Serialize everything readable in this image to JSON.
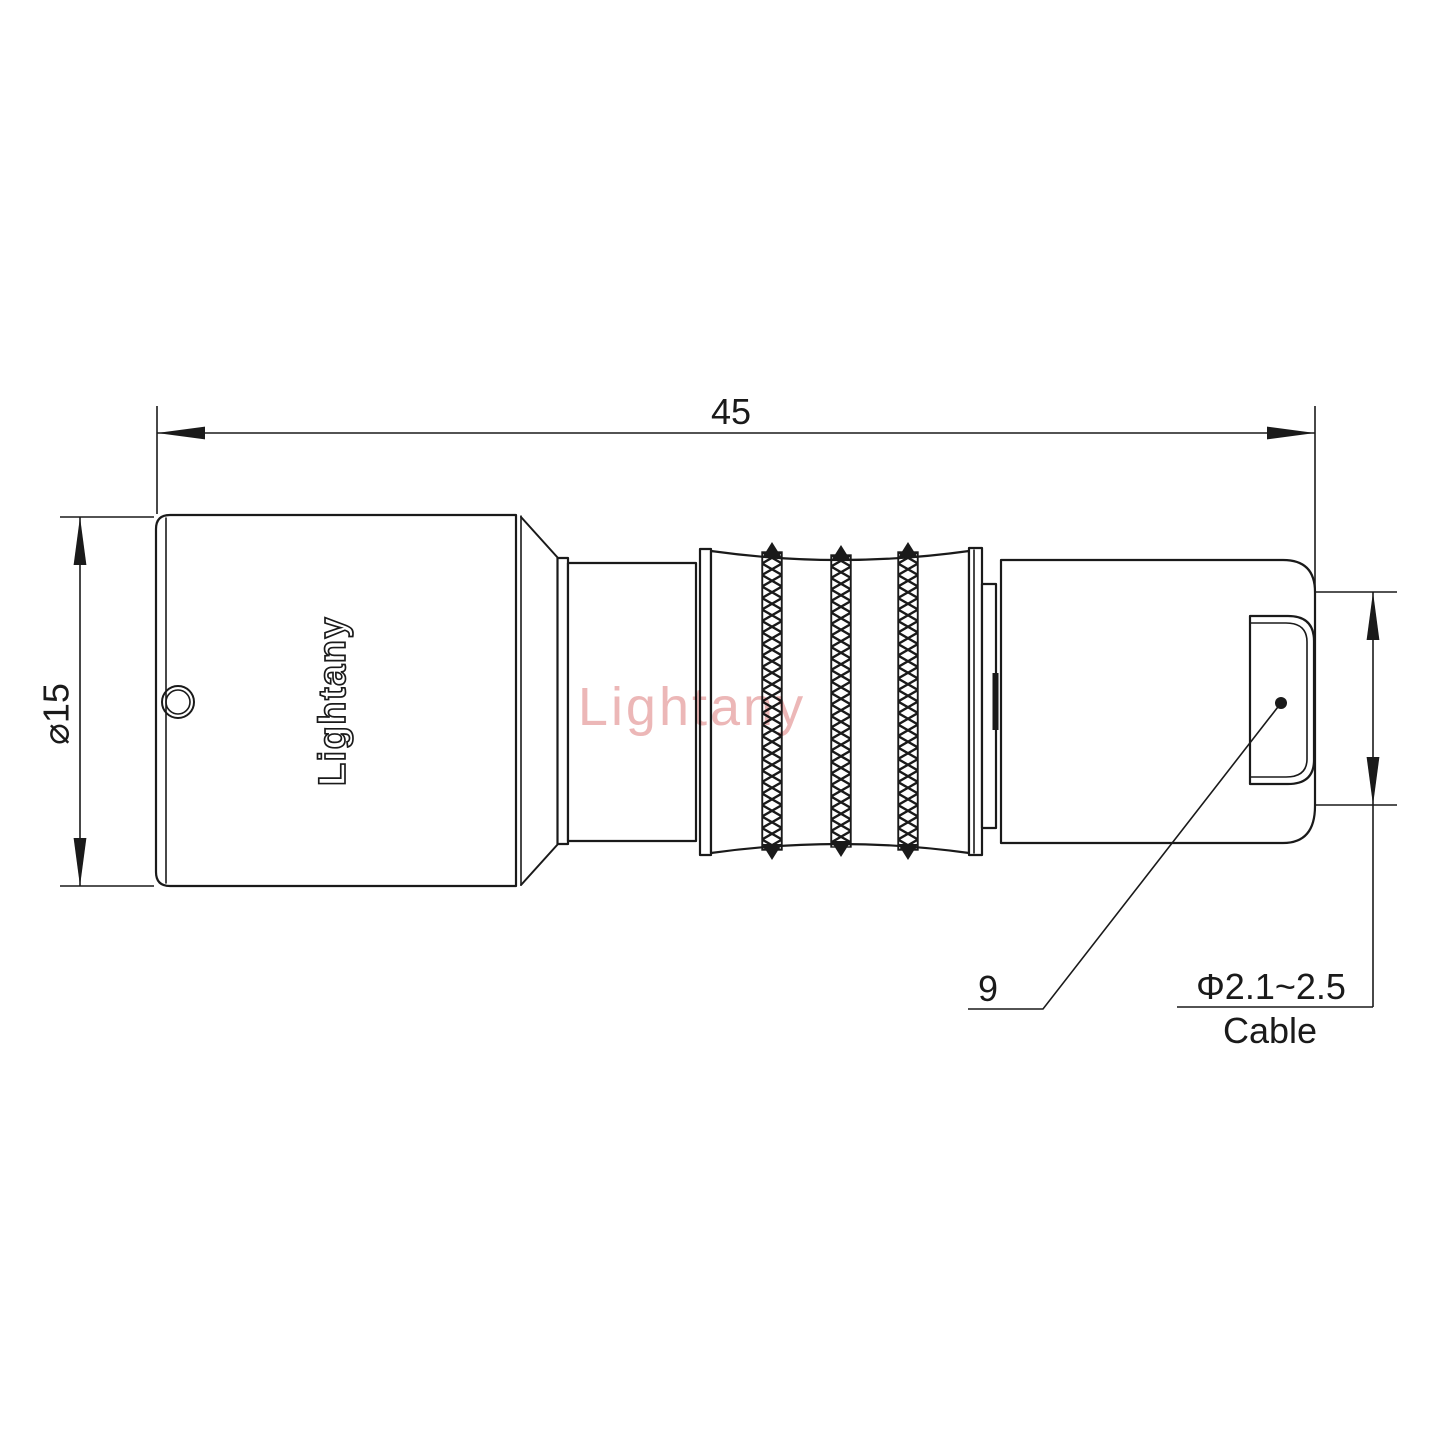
{
  "brand": {
    "watermark": "Lightany",
    "engraved": "Lightany"
  },
  "dimensions": {
    "overall_length": "45",
    "body_diameter": "⌀15",
    "rear_length": "9",
    "cable_diameter": "Φ2.1~2.5",
    "cable_label": "Cable"
  },
  "colors": {
    "line-color": "#1a1a1a",
    "watermark-color": "#ecb7b7",
    "background-color": "#ffffff"
  }
}
